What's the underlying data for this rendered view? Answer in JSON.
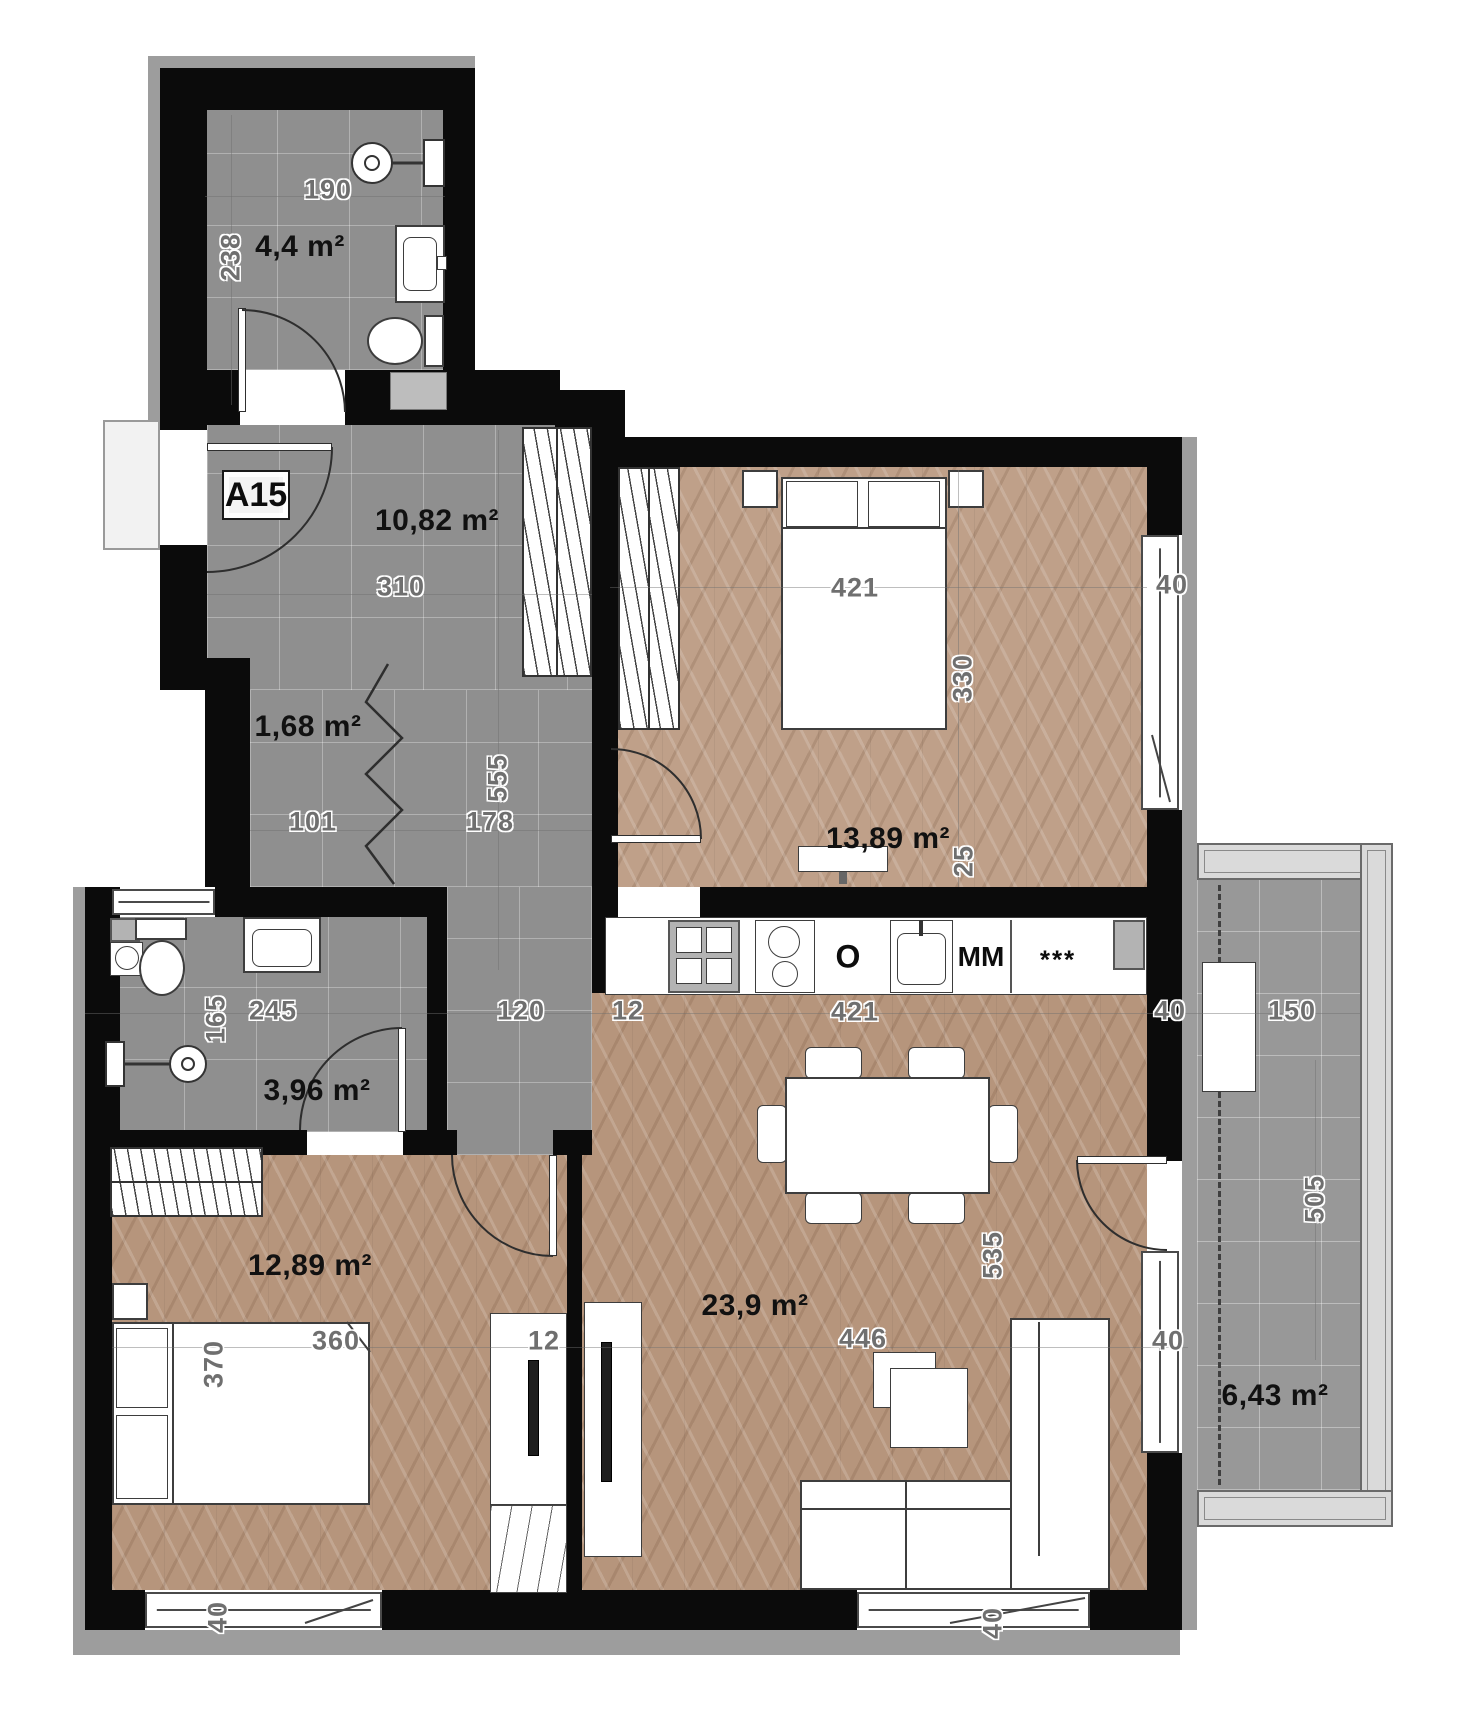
{
  "plan": {
    "unit": "A15",
    "type_note": "apartment floor plan",
    "rooms": [
      {
        "name": "bathroom-top",
        "area": "4,4 m²"
      },
      {
        "name": "hallway",
        "area": "10,82 m²"
      },
      {
        "name": "closet",
        "area": "1,68 m²"
      },
      {
        "name": "bathroom-lower",
        "area": "3,96 m²"
      },
      {
        "name": "bedroom-top",
        "area": "13,89 m²"
      },
      {
        "name": "bedroom-left",
        "area": "12,89 m²"
      },
      {
        "name": "living-room",
        "area": "23,9 m²"
      },
      {
        "name": "balcony",
        "area": "6,43 m²"
      }
    ],
    "dims": {
      "d190": "190",
      "d238": "238",
      "d310": "310",
      "d555": "555",
      "d178": "178",
      "d101": "101",
      "d165": "165",
      "d245": "245",
      "d120": "120",
      "d12k": "12",
      "d421k": "421",
      "d40k": "40",
      "d150": "150",
      "d421bed": "421",
      "d330": "330",
      "d25": "25",
      "d40tr": "40",
      "d535": "535",
      "d446": "446",
      "d505": "505",
      "d12p": "12",
      "d370": "370",
      "d360": "360",
      "d40bl": "40",
      "d40bc": "40",
      "d40r": "40"
    },
    "appliances": {
      "oven": "O",
      "mm": "MM",
      "stars": "***"
    },
    "palette": {
      "wall": "#0b0b0b",
      "tile_floor": "#8f8f8f",
      "wood_floor": "#b6957c",
      "wood_floor_light": "#bfa089",
      "exterior_band": "#9d9d9d",
      "dim_text": "#6f6f6f",
      "area_text": "#111111"
    }
  }
}
